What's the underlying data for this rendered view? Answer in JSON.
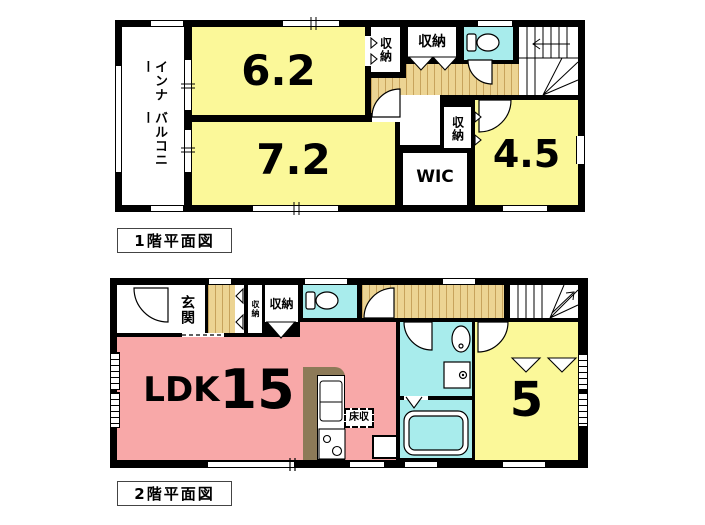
{
  "floor1": {
    "caption": "1階平面図",
    "balcony": {
      "line1": "インナー",
      "line2": "バルコニー"
    },
    "rooms": {
      "room62": "6.2",
      "room72": "7.2",
      "room45": "4.5",
      "wic": "WIC",
      "closet1": "収納",
      "closet2": "収納",
      "closet3": "収納"
    }
  },
  "floor2": {
    "caption": "2階平面図",
    "rooms": {
      "genkan": "玄関",
      "closet_a": "収納",
      "closet_b": "収納",
      "closet_c": "収納",
      "closet_d": "収納",
      "ldk": "LDK",
      "ldk_size": "15",
      "room5": "5",
      "floor_storage": "床収"
    }
  },
  "colors": {
    "room_yellow": "#FBF899",
    "ldk_pink": "#F8A8A8",
    "water_cyan": "#A8ECEC",
    "hall_tan": "#ECD493",
    "wall_black": "#000000"
  }
}
